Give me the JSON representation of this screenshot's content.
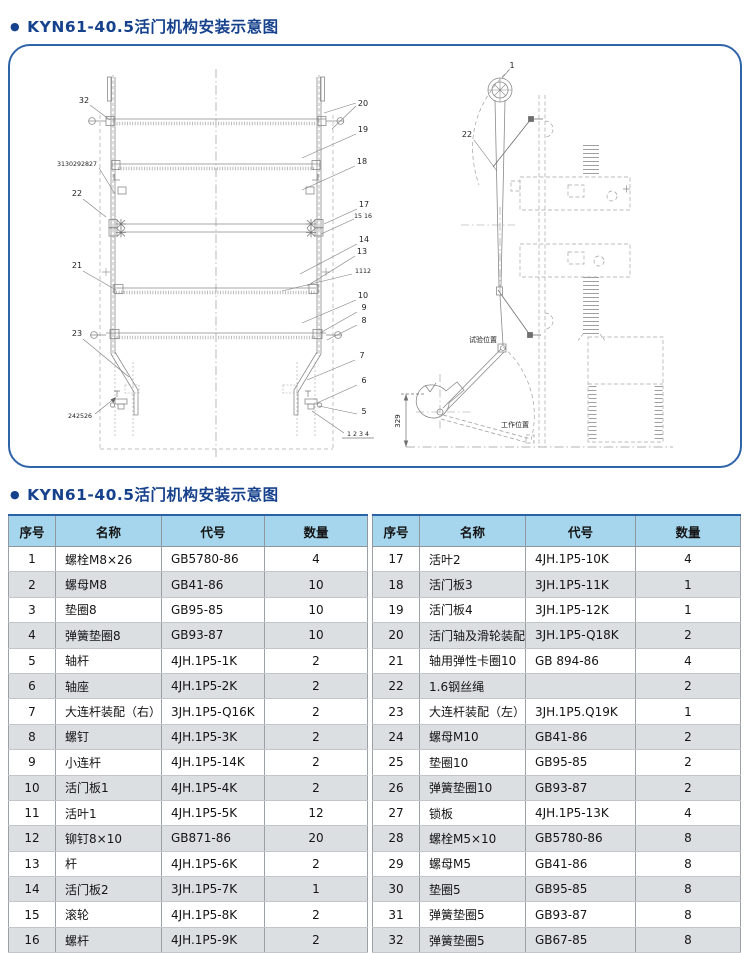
{
  "page": {
    "bullet": "●",
    "title1": "KYN61-40.5活门机构安装示意图",
    "title2": "KYN61-40.5活门机构安装示意图"
  },
  "colors": {
    "accent_blue": "#2f64a9",
    "title_blue": "#16418c",
    "table_header_bg": "#a6d6ee",
    "table_row_shade": "#dcdfe2",
    "drawing_line": "#8a8a8a"
  },
  "diagram": {
    "front": {
      "c32": "32",
      "c31_27": "3130292827",
      "c22": "22",
      "c21": "21",
      "c23": "23",
      "c24_26": "242526",
      "c20": "20",
      "c19": "19",
      "c18": "18",
      "c17": "17",
      "c15_16": "15 16",
      "c14": "14",
      "c13": "13",
      "c11_12": "1112",
      "c10": "10",
      "c9": "9",
      "c8": "8",
      "c7": "7",
      "c6": "6",
      "c5": "5",
      "c1_4": "1 2 3 4"
    },
    "side": {
      "c1": "1",
      "c22": "22",
      "test_position": "试验位置",
      "work_position": "工作位置",
      "dim": "329"
    }
  },
  "table": {
    "headers": [
      "序号",
      "名称",
      "代号",
      "数量"
    ],
    "left_rows": [
      [
        "1",
        "螺栓M8×26",
        "GB5780-86",
        "4"
      ],
      [
        "2",
        "螺母M8",
        "GB41-86",
        "10"
      ],
      [
        "3",
        "垫圈8",
        "GB95-85",
        "10"
      ],
      [
        "4",
        "弹簧垫圈8",
        "GB93-87",
        "10"
      ],
      [
        "5",
        "轴杆",
        "4JH.1P5-1K",
        "2"
      ],
      [
        "6",
        "轴座",
        "4JH.1P5-2K",
        "2"
      ],
      [
        "7",
        "大连杆装配（右）",
        "3JH.1P5-Q16K",
        "2"
      ],
      [
        "8",
        "螺钉",
        "4JH.1P5-3K",
        "2"
      ],
      [
        "9",
        "小连杆",
        "4JH.1P5-14K",
        "2"
      ],
      [
        "10",
        "活门板1",
        "4JH.1P5-4K",
        "2"
      ],
      [
        "11",
        "活叶1",
        "4JH.1P5-5K",
        "12"
      ],
      [
        "12",
        "铆钉8×10",
        "GB871-86",
        "20"
      ],
      [
        "13",
        "杆",
        "4JH.1P5-6K",
        "2"
      ],
      [
        "14",
        "活门板2",
        "3JH.1P5-7K",
        "1"
      ],
      [
        "15",
        "滚轮",
        "4JH.1P5-8K",
        "2"
      ],
      [
        "16",
        "螺杆",
        "4JH.1P5-9K",
        "2"
      ]
    ],
    "right_rows": [
      [
        "17",
        "活叶2",
        "4JH.1P5-10K",
        "4"
      ],
      [
        "18",
        "活门板3",
        "3JH.1P5-11K",
        "1"
      ],
      [
        "19",
        "活门板4",
        "3JH.1P5-12K",
        "1"
      ],
      [
        "20",
        "活门轴及滑轮装配",
        "3JH.1P5-Q18K",
        "2"
      ],
      [
        "21",
        "轴用弹性卡圈10",
        "GB 894-86",
        "4"
      ],
      [
        "22",
        "1.6钢丝绳",
        "",
        "2"
      ],
      [
        "23",
        "大连杆装配（左）",
        "3JH.1P5.Q19K",
        "1"
      ],
      [
        "24",
        "螺母M10",
        "GB41-86",
        "2"
      ],
      [
        "25",
        "垫圈10",
        "GB95-85",
        "2"
      ],
      [
        "26",
        "弹簧垫圈10",
        "GB93-87",
        "2"
      ],
      [
        "27",
        "锁板",
        "4JH.1P5-13K",
        "4"
      ],
      [
        "28",
        "螺栓M5×10",
        "GB5780-86",
        "8"
      ],
      [
        "29",
        "螺母M5",
        "GB41-86",
        "8"
      ],
      [
        "30",
        "垫圈5",
        "GB95-85",
        "8"
      ],
      [
        "31",
        "弹簧垫圈5",
        "GB93-87",
        "8"
      ],
      [
        "32",
        "弹簧垫圈5",
        "GB67-85",
        "8"
      ]
    ]
  }
}
